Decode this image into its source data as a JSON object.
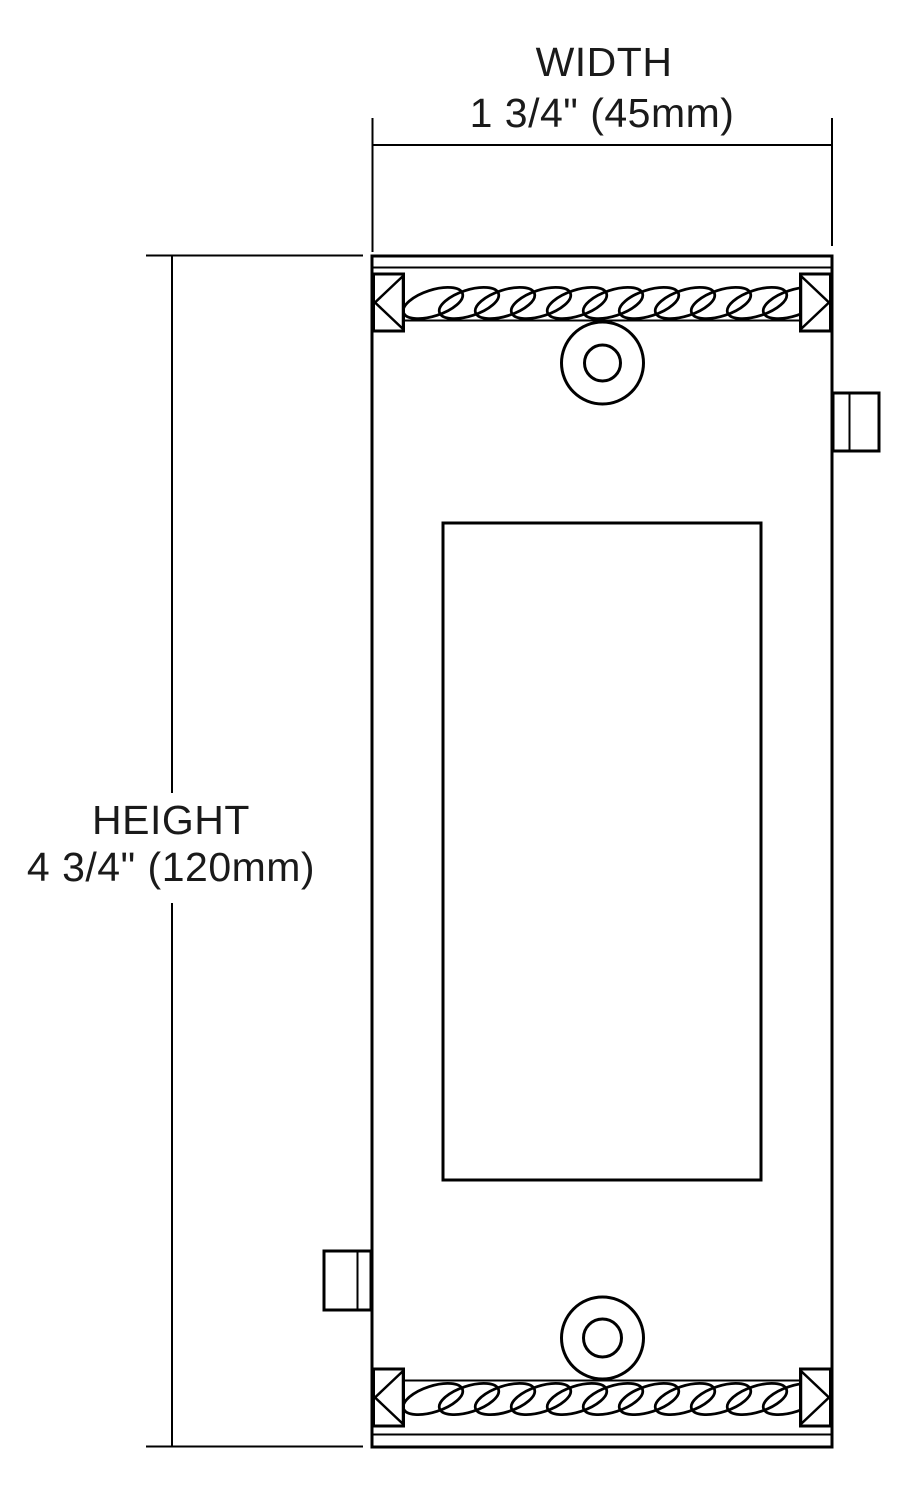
{
  "diagram": {
    "title": "fixture-dimension-drawing",
    "width_dimension": {
      "label": "WIDTH",
      "value": "1 3/4\" (45mm)"
    },
    "height_dimension": {
      "label": "HEIGHT",
      "value": "4 3/4\" (120mm)"
    }
  },
  "colors": {
    "line": "#000000",
    "text": "#1a1a1a",
    "background": "#ffffff"
  }
}
